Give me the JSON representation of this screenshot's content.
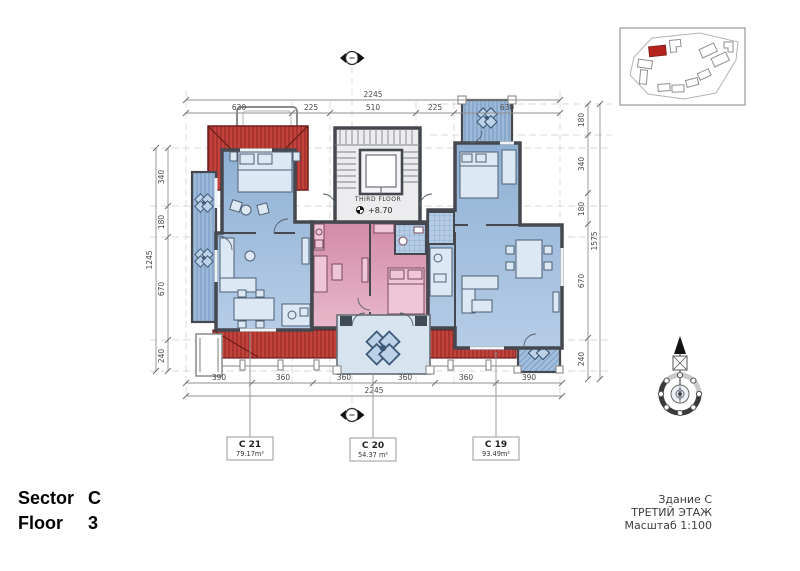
{
  "title_block": {
    "sector_label": "Sector",
    "sector_value": "C",
    "floor_label": "Floor",
    "floor_value": "3"
  },
  "stamp": {
    "building": "Здание С",
    "floor": "ТРЕТИЙ ЭТАЖ",
    "scale": "Масштаб 1:100"
  },
  "core": {
    "floor_label": "THIRD FLOOR",
    "elevation": "+8.70"
  },
  "units": [
    {
      "id": "C 21",
      "area": "79.17m²"
    },
    {
      "id": "C 20",
      "area": "54.37 m²"
    },
    {
      "id": "C 19",
      "area": "93.49m²"
    }
  ],
  "dimensions": {
    "top": {
      "total": "2245",
      "segments": [
        "630",
        "225",
        "510",
        "225",
        "630"
      ]
    },
    "bottom": {
      "total": "2245",
      "segments": [
        "390",
        "360",
        "360",
        "360",
        "360",
        "390"
      ]
    },
    "left": {
      "total": "1245",
      "segments": [
        "340",
        "180",
        "670",
        "240"
      ]
    },
    "right": {
      "total": "1575",
      "segments": [
        "180",
        "340",
        "180",
        "670",
        "240"
      ]
    }
  },
  "colors": {
    "apartment_blue": "#9fbddc",
    "apartment_blue_dark": "#7c9fc4",
    "apartment_pink": "#dc9db6",
    "apartment_pink_dark": "#c97e9d",
    "roof_red": "#c2423c",
    "roof_red_dark": "#8e2824",
    "wall": "#45484e"
  }
}
